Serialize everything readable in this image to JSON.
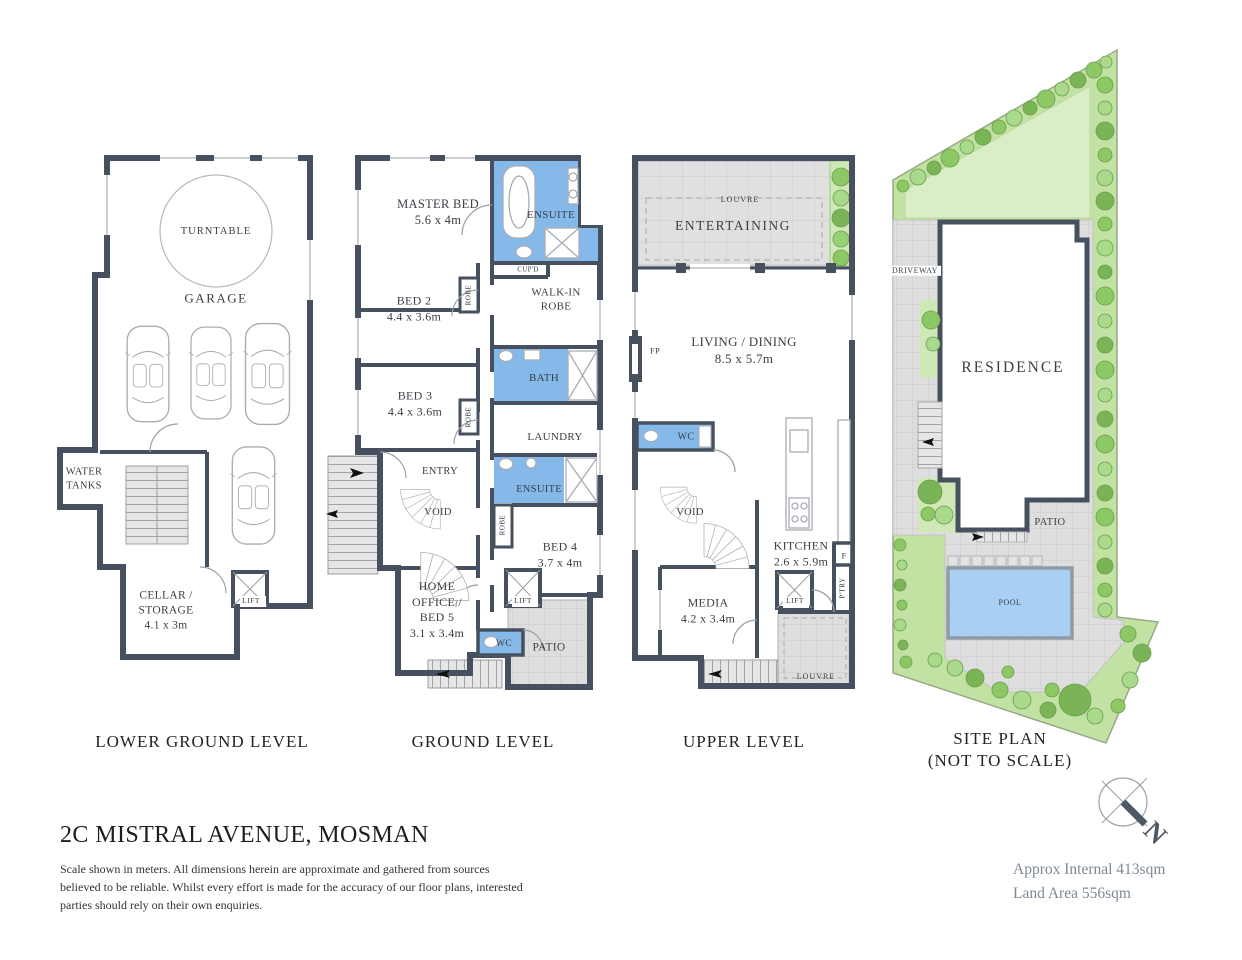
{
  "title": "2C MISTRAL AVENUE, MOSMAN",
  "disclaimer": "Scale shown in meters. All dimensions herein are approximate and gathered from sources believed to be reliable. Whilst every effort is made for the accuracy of our floor plans, interested parties should rely on their own enquiries.",
  "areas": {
    "internal": "Approx Internal 413sqm",
    "land": "Land Area 556sqm"
  },
  "compass": {
    "letter": "N"
  },
  "colors": {
    "wall": "#46505E",
    "wet_area": "#84B9EA",
    "paving": "#DEDEDE",
    "lawn": "#D9EEC6",
    "garden": "#C1E2A2",
    "pool": "#A9CFF3",
    "text": "#3B4046",
    "muted_text": "#7E8996"
  },
  "levels": {
    "lower": {
      "label": "LOWER GROUND LEVEL",
      "rooms": {
        "turntable": "TURNTABLE",
        "garage": "GARAGE",
        "water_tanks": "WATER TANKS",
        "cellar": {
          "name": "CELLAR / STORAGE",
          "dims": "4.1 x 3m"
        },
        "lift": "LIFT"
      }
    },
    "ground": {
      "label": "GROUND LEVEL",
      "rooms": {
        "master": {
          "name": "MASTER BED",
          "dims": "5.6 x 4m"
        },
        "ensuite1": "ENSUITE",
        "cupd": "CUP'D",
        "walkin": "WALK-IN ROBE",
        "bed2": {
          "name": "BED 2",
          "dims": "4.4 x 3.6m"
        },
        "robe1": "ROBE",
        "bed3": {
          "name": "BED 3",
          "dims": "4.4 x 3.6m"
        },
        "robe2": "ROBE",
        "bath": "BATH",
        "laundry": "LAUNDRY",
        "entry": "ENTRY",
        "void": "VOID",
        "ensuite2": "ENSUITE",
        "robe3": "ROBE",
        "bed4": {
          "name": "BED 4",
          "dims": "3.7 x 4m"
        },
        "home_office": {
          "name": "HOME OFFICE / BED 5",
          "dims": "3.1 x 3.4m"
        },
        "wc": "WC",
        "lift": "LIFT",
        "patio": "PATIO"
      }
    },
    "upper": {
      "label": "UPPER LEVEL",
      "rooms": {
        "entertaining": "ENTERTAINING",
        "louvre_top": "LOUVRE",
        "living": {
          "name": "LIVING / DINING",
          "dims": "8.5 x 5.7m"
        },
        "fp": "FP",
        "wc": "WC",
        "void": "VOID",
        "kitchen": {
          "name": "KITCHEN",
          "dims": "2.6 x 5.9m"
        },
        "fridge": "F",
        "pantry": "P'TRY",
        "lift": "LIFT",
        "media": {
          "name": "MEDIA",
          "dims": "4.2 x 3.4m"
        },
        "louvre_bottom": "LOUVRE"
      }
    },
    "site": {
      "label1": "SITE PLAN",
      "label2": "(NOT TO SCALE)",
      "rooms": {
        "driveway": "DRIVEWAY",
        "residence": "RESIDENCE",
        "patio": "PATIO",
        "pool": "POOL"
      }
    }
  }
}
